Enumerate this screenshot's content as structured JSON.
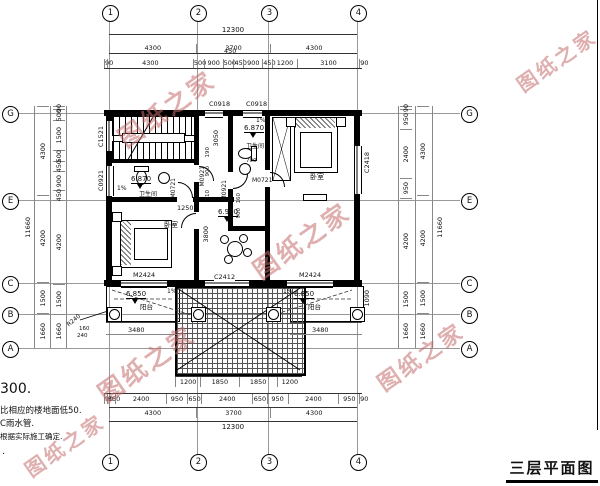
{
  "title": "三层平面图",
  "watermark": "图纸之家",
  "notes": {
    "l1": "300.",
    "l2": "比相应的楼地面低50.",
    "l3": "C雨水管.",
    "l4": "根据实际施工确定.",
    "l5": "."
  },
  "grid": {
    "cols": [
      "1",
      "2",
      "3",
      "4"
    ],
    "rows": [
      "G",
      "E",
      "C",
      "B",
      "A"
    ]
  },
  "dims": {
    "top_total": "12300",
    "top_major": [
      "4300",
      "3700",
      "4300"
    ],
    "top_detail": [
      "90",
      "4300",
      "500",
      "900",
      "500",
      "450",
      "900",
      "450",
      "1200",
      "3100",
      "90"
    ],
    "top_float": "450",
    "bottom_total": "12300",
    "bottom_major": [
      "4300",
      "3700",
      "4300"
    ],
    "bottom_detail": [
      "90",
      "350",
      "2400",
      "950",
      "650",
      "2400",
      "650",
      "950",
      "2400",
      "950",
      "90"
    ],
    "roof_row": [
      "1200",
      "1850",
      "1850",
      "1200"
    ],
    "left_outer": "11660",
    "left_mid": [
      "4300",
      "4200",
      "1500",
      "1660"
    ],
    "left_inner": [
      "90",
      "500",
      "1500",
      "500",
      "450",
      "900",
      "450",
      "4200",
      "1500",
      "1660"
    ],
    "right_outer": "11660",
    "right_mid": [
      "4300",
      "4200",
      "1500",
      "1660"
    ],
    "right_inner": [
      "90",
      "950",
      "2400",
      "950",
      "4200",
      "1500",
      "1660"
    ],
    "balcony_left": "3480",
    "balcony_right": "3480",
    "balcony_depth": "1090",
    "hall_width": "1250",
    "bath_depth": "3050",
    "hall_depth": "3800",
    "small_left": [
      "190",
      "900",
      "710"
    ],
    "small_right": [
      "160",
      "900"
    ],
    "door_width": "700",
    "col_dims": [
      "160",
      "240"
    ],
    "column_radius": "R240"
  },
  "openings": {
    "win_top": "C0918",
    "win_left_upper": "C1521",
    "win_left_lower": "C0921",
    "win_right": "C2418",
    "win_center": "C2412",
    "door_balcony": "M2424",
    "door_07": "M0721",
    "door_09": "M0921"
  },
  "rooms": {
    "bath": "卫生间",
    "bedroom": "卧室",
    "balcony": "阳台"
  },
  "levels": {
    "bath": "6.870",
    "hall": "6.900",
    "balcony": "6.850",
    "slope": "1%"
  }
}
